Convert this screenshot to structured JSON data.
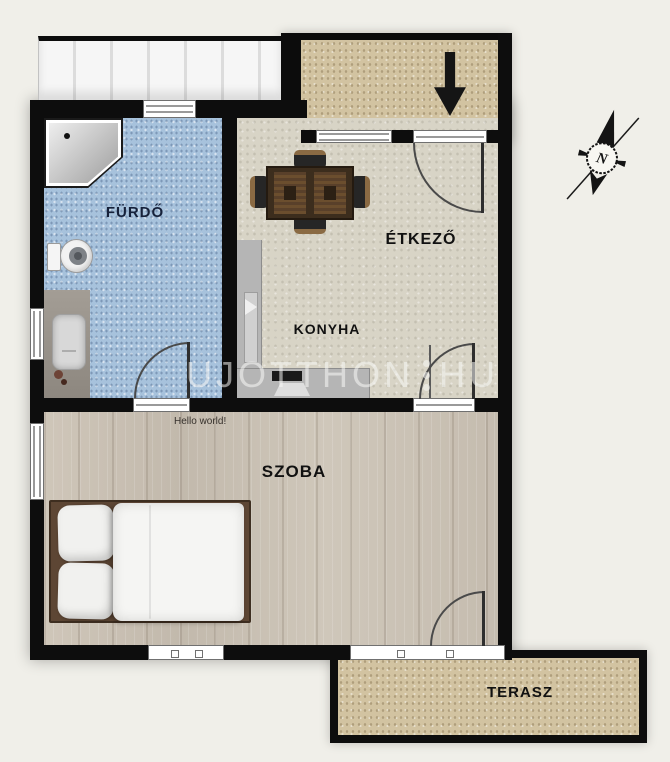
{
  "plan_title": "Apartment floor plan",
  "rooms": {
    "bathroom": {
      "label": "FÜRDŐ"
    },
    "dining": {
      "label": "ÉTKEZŐ"
    },
    "kitchen": {
      "label": "KONYHA"
    },
    "bedroom": {
      "label": "SZOBA"
    },
    "terrace": {
      "label": "TERASZ"
    }
  },
  "annotations": {
    "hello": "Hello world!"
  },
  "watermark": {
    "left": "UJOTTHON",
    "right": "HU"
  },
  "compass": {
    "north": "N"
  },
  "icons": {
    "entrance_arrow": "down-arrow",
    "compass_rose": "north-compass"
  },
  "colors": {
    "wall": "#0d0d0d",
    "bathroom_floor": "#a7c2dc",
    "kitchen_floor": "#d8d4c6",
    "bedroom_floor": "#cbc2b5",
    "outdoor_paving": "#d2c3a1",
    "background": "#f0efe9",
    "watermark": "rgba(248,248,246,0.55)"
  }
}
